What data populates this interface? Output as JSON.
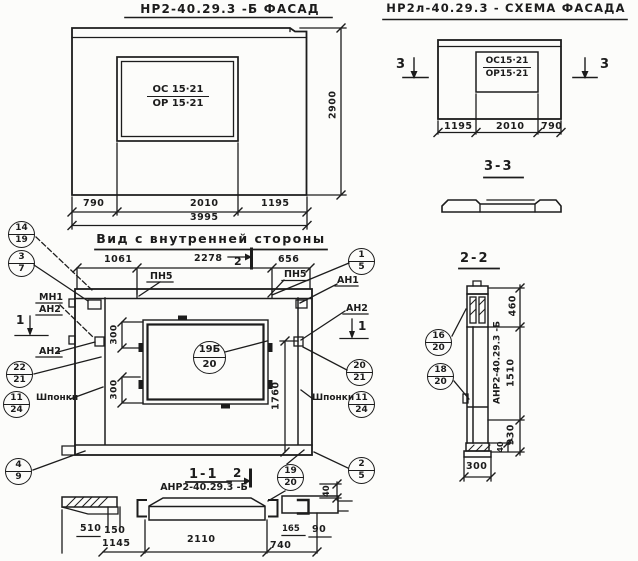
{
  "ink": "#1c1c1c",
  "facade": {
    "title": "НР2-40.29.3 -Б   ФАСАД",
    "window_mark": {
      "top": "ОС 15·21",
      "bottom": "ОР 15·21"
    },
    "dims": {
      "left": "790",
      "middle": "2010",
      "right": "1195",
      "total": "3995",
      "height": "2900"
    }
  },
  "schema": {
    "title": "НР2л-40.29.3 - СХЕМА ФАСАДА",
    "window_mark": {
      "top": "ОС15·21",
      "bottom": "ОР15·21"
    },
    "dims": {
      "left": "1195",
      "middle": "2010",
      "right": "790"
    },
    "section_mark": "3",
    "section_title": "3-3"
  },
  "inner": {
    "title": "Вид с внутренней стороны",
    "dims": {
      "top_left": "1061",
      "top_middle": "2278",
      "top_right": "656",
      "offset": "300",
      "right_height": "1760"
    },
    "labels": {
      "mn1": "МН1",
      "an1": "АН1",
      "an2": "АН2",
      "pn5": "ПН5",
      "shponki": "Шпонки"
    },
    "section_mark_1": "1",
    "section_mark_2": "2"
  },
  "section_1_1": {
    "title": "1-1",
    "label": "АНР2-40.29.3 -Б",
    "dims": {
      "d510": "510",
      "d150": "150",
      "d1145": "1145",
      "d2110": "2110",
      "d740": "740",
      "d165": "165",
      "d90": "90",
      "d40": "40"
    }
  },
  "section_2_2": {
    "title": "2-2",
    "label": "АНР2-40.29.3 -Б",
    "dims": {
      "d460": "460",
      "d1510": "1510",
      "d930": "930",
      "d40": "40",
      "d300": "300"
    }
  },
  "callouts": [
    {
      "top": "14",
      "bottom": "19"
    },
    {
      "top": "3",
      "bottom": "7"
    },
    {
      "top": "22",
      "bottom": "21"
    },
    {
      "top": "11",
      "bottom": "24"
    },
    {
      "top": "4",
      "bottom": "9"
    },
    {
      "top": "1",
      "bottom": "5"
    },
    {
      "top": "20",
      "bottom": "21"
    },
    {
      "top": "11",
      "bottom": "24"
    },
    {
      "top": "2",
      "bottom": "5"
    },
    {
      "top": "19",
      "bottom": "20"
    },
    {
      "top": "19Б",
      "bottom": "20"
    },
    {
      "top": "16",
      "bottom": "20"
    },
    {
      "top": "18",
      "bottom": "20"
    }
  ]
}
